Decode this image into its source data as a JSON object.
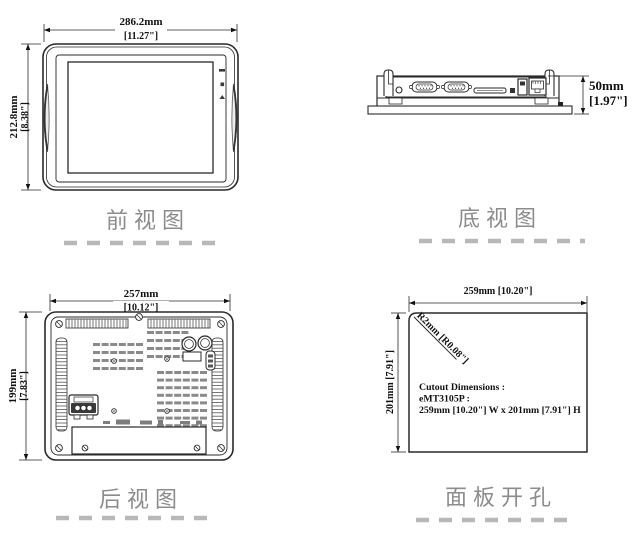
{
  "front_view": {
    "title": "前视图",
    "width_mm": "286.2mm",
    "width_in": "[11.27\"]",
    "height_mm": "212.8mm",
    "height_in": "[8.38\"]"
  },
  "bottom_view": {
    "title": "底视图",
    "depth_mm": "50mm",
    "depth_in": "[1.97\"]"
  },
  "rear_view": {
    "title": "后视图",
    "width_mm": "257mm",
    "width_in": "[10.12\"]",
    "height_mm": "199mm",
    "height_in": "[7.83\"]"
  },
  "panel_cutout": {
    "title": "面板开孔",
    "width": "259mm [10.20\"]",
    "height": "201mm [7.91\"]",
    "radius": "R2mm [R0.08\"]",
    "note1": "Cutout Dimensions :",
    "note2": "eMT3105P :",
    "note3": "259mm [10.20\"] W x 201mm [7.91\"] H"
  },
  "colors": {
    "line": "#2a2a2a",
    "label_gray": "#8c8c8c",
    "dash_gray": "#b8b8b8"
  }
}
